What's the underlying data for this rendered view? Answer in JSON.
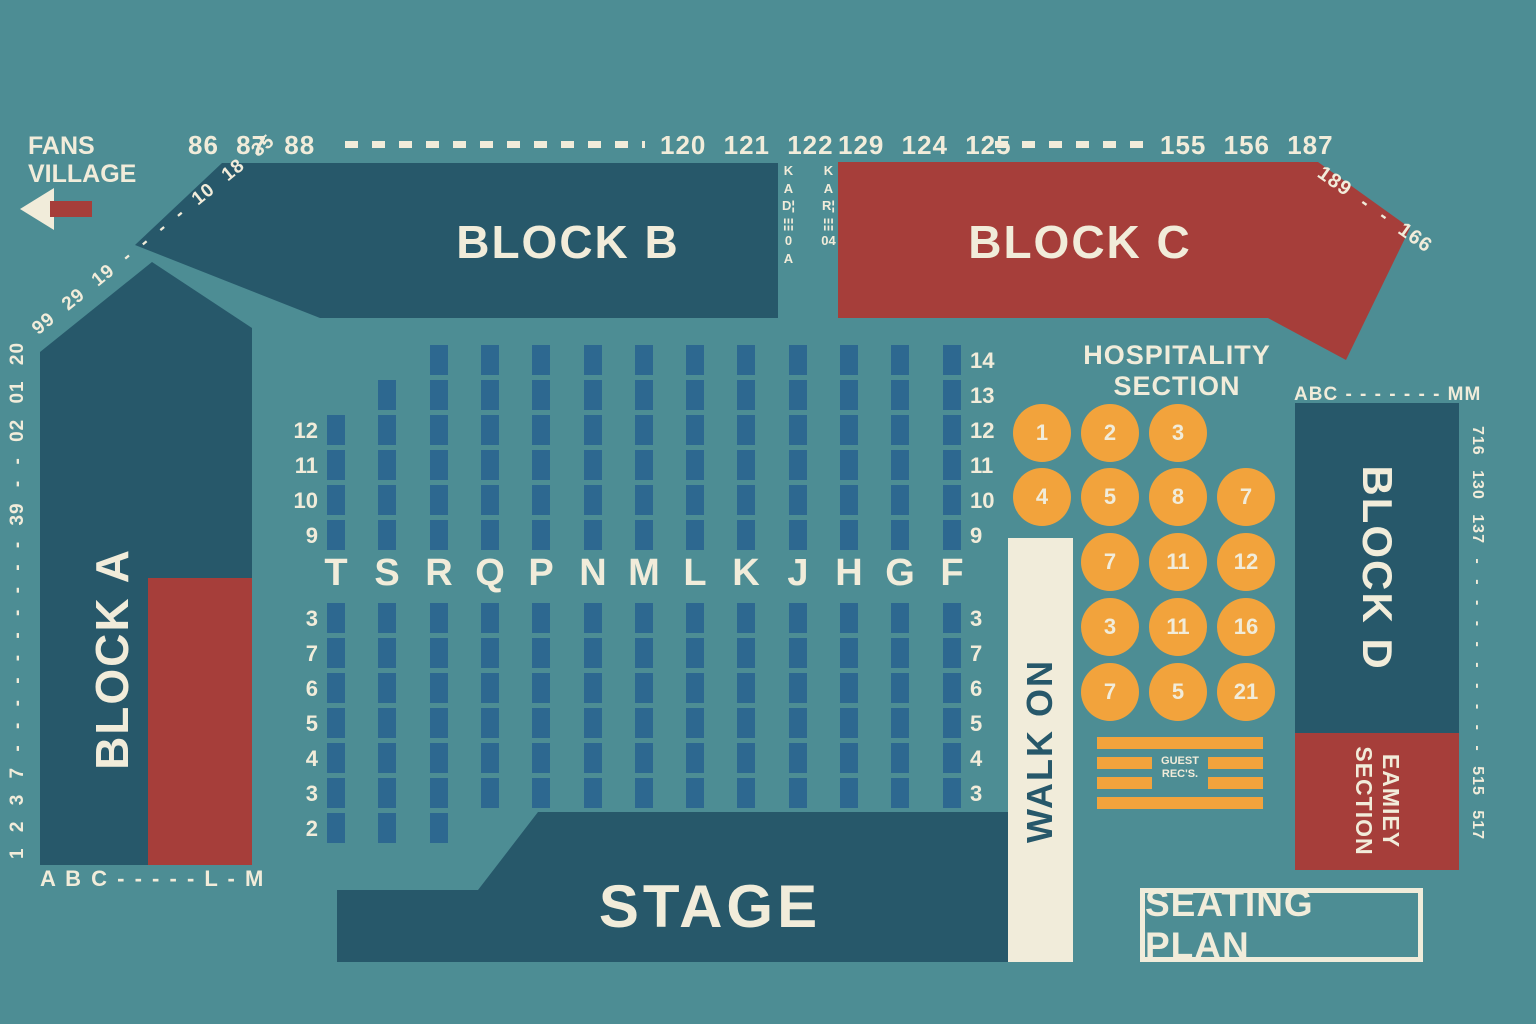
{
  "title": "SEATING PLAN",
  "colors": {
    "background": "#4d8d94",
    "block_dark": "#27586a",
    "block_red": "#a63e3a",
    "accent_orange": "#f2a33c",
    "cream": "#f1ecda",
    "seat_blue": "#2d6890"
  },
  "fans_village": {
    "line1": "FANS",
    "line2": "VILLAGE"
  },
  "top_axis": {
    "block_b_left": "86 87 88",
    "block_b_right": "120 121 122",
    "block_c_left": "129 124 125",
    "block_c_right": "155 156 187",
    "block_c_corner": "189 - - 166"
  },
  "edge_labels": {
    "block_a_diagonal": "99 29 19 - - - -  10 18 35",
    "block_a_left": "1 2 3 7 - - - - - - - - - -  39 - -  02 01 20",
    "block_a_bottom": "A B C - - - - - L - M",
    "block_b_right_vertical": "KAD¦¦¦¦0A",
    "block_c_left_vertical": "KAR¦¦¦¦04",
    "block_d_top": "ABC - - - - - - - MM",
    "block_d_right": "716 130 137  - - - - - - - - - -  515 517"
  },
  "blocks": {
    "a": "BLOCK A",
    "b": "BLOCK B",
    "c": "BLOCK C",
    "d": "BLOCK D",
    "family_line1": "EAMIEY",
    "family_line2": "SECTION"
  },
  "stage_label": "STAGE",
  "walkway_label": "WALK ON",
  "hospitality": {
    "title_line1": "HOSPITALITY",
    "title_line2": "SECTION",
    "tables": [
      {
        "row": 0,
        "col": 0,
        "label": "1"
      },
      {
        "row": 0,
        "col": 1,
        "label": "2"
      },
      {
        "row": 0,
        "col": 2,
        "label": "3"
      },
      {
        "row": 1,
        "col": 0,
        "label": "4"
      },
      {
        "row": 1,
        "col": 1,
        "label": "5"
      },
      {
        "row": 1,
        "col": 2,
        "label": "8"
      },
      {
        "row": 1,
        "col": 3,
        "label": "7"
      },
      {
        "row": 2,
        "col": 1,
        "label": "7"
      },
      {
        "row": 2,
        "col": 2,
        "label": "11"
      },
      {
        "row": 2,
        "col": 3,
        "label": "12"
      },
      {
        "row": 3,
        "col": 1,
        "label": "3"
      },
      {
        "row": 3,
        "col": 2,
        "label": "11"
      },
      {
        "row": 3,
        "col": 3,
        "label": "16"
      },
      {
        "row": 4,
        "col": 1,
        "label": "7"
      },
      {
        "row": 4,
        "col": 2,
        "label": "5"
      },
      {
        "row": 4,
        "col": 3,
        "label": "21"
      }
    ],
    "guest_line1": "GUEST",
    "guest_line2": "REC'S."
  },
  "seat_grid": {
    "columns": [
      {
        "letter": "T",
        "upper": 4,
        "lower": 7
      },
      {
        "letter": "S",
        "upper": 5,
        "lower": 7
      },
      {
        "letter": "R",
        "upper": 6,
        "lower": 7
      },
      {
        "letter": "Q",
        "upper": 6,
        "lower": 6
      },
      {
        "letter": "P",
        "upper": 6,
        "lower": 6
      },
      {
        "letter": "N",
        "upper": 6,
        "lower": 6
      },
      {
        "letter": "M",
        "upper": 6,
        "lower": 6
      },
      {
        "letter": "L",
        "upper": 6,
        "lower": 6
      },
      {
        "letter": "K",
        "upper": 6,
        "lower": 6
      },
      {
        "letter": "J",
        "upper": 6,
        "lower": 6
      },
      {
        "letter": "H",
        "upper": 6,
        "lower": 6
      },
      {
        "letter": "G",
        "upper": 6,
        "lower": 6
      },
      {
        "letter": "F",
        "upper": 6,
        "lower": 6
      }
    ],
    "left_upper": [
      "12",
      "11",
      "10",
      "9"
    ],
    "left_lower": [
      "3",
      "7",
      "6",
      "5",
      "4",
      "3",
      "2"
    ],
    "right_upper": [
      "14",
      "13",
      "12",
      "11",
      "10",
      "9"
    ],
    "right_lower": [
      "3",
      "7",
      "6",
      "5",
      "4",
      "3"
    ]
  },
  "legend_label": "SEATING PLAN"
}
